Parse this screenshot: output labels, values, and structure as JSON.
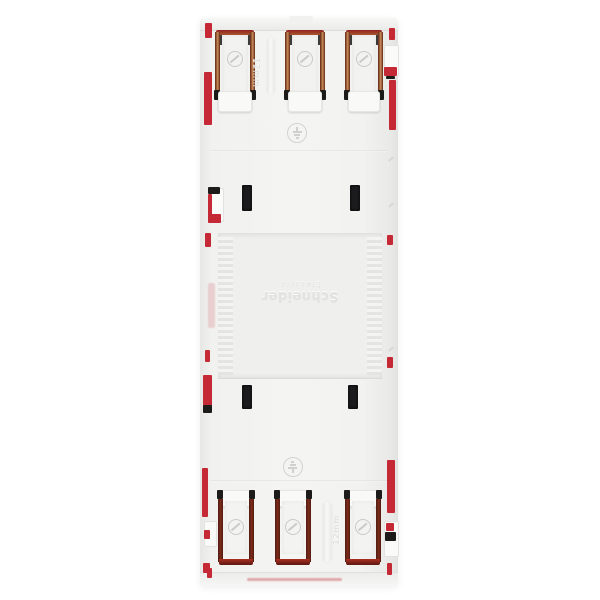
{
  "scene": {
    "type": "product-photo",
    "subject": "Schneider Electric modular comb busbar / terminal block, rear view on white background",
    "background": "#ffffff"
  },
  "branding": {
    "line1": "Schneider",
    "line2": "Electric",
    "note": "embossed logo rotated 180 degrees in centre panel"
  },
  "labels": {
    "pitch_top": "12mm",
    "pitch_bottom": "12mm"
  },
  "counts": {
    "top_terminals": 3,
    "bottom_terminals": 3,
    "mounting_slots": 4,
    "earth_symbols": 2,
    "screw_symbols": 6
  },
  "colors": {
    "background": "#ffffff",
    "body": "#f2f2f0",
    "panel": "#efefed",
    "rib_light": "#f4f4f2",
    "rib_dark": "#e3e3e1",
    "red": "#c42935",
    "red_dark": "#8f2220",
    "copper": "#a8572e",
    "copper_dark": "#5e2713",
    "copper_light": "#c98a58",
    "maroon": "#7c2a1a",
    "terminal_red": "#a93024",
    "black": "#1d1b1a",
    "emboss": "#e2e2e0"
  }
}
